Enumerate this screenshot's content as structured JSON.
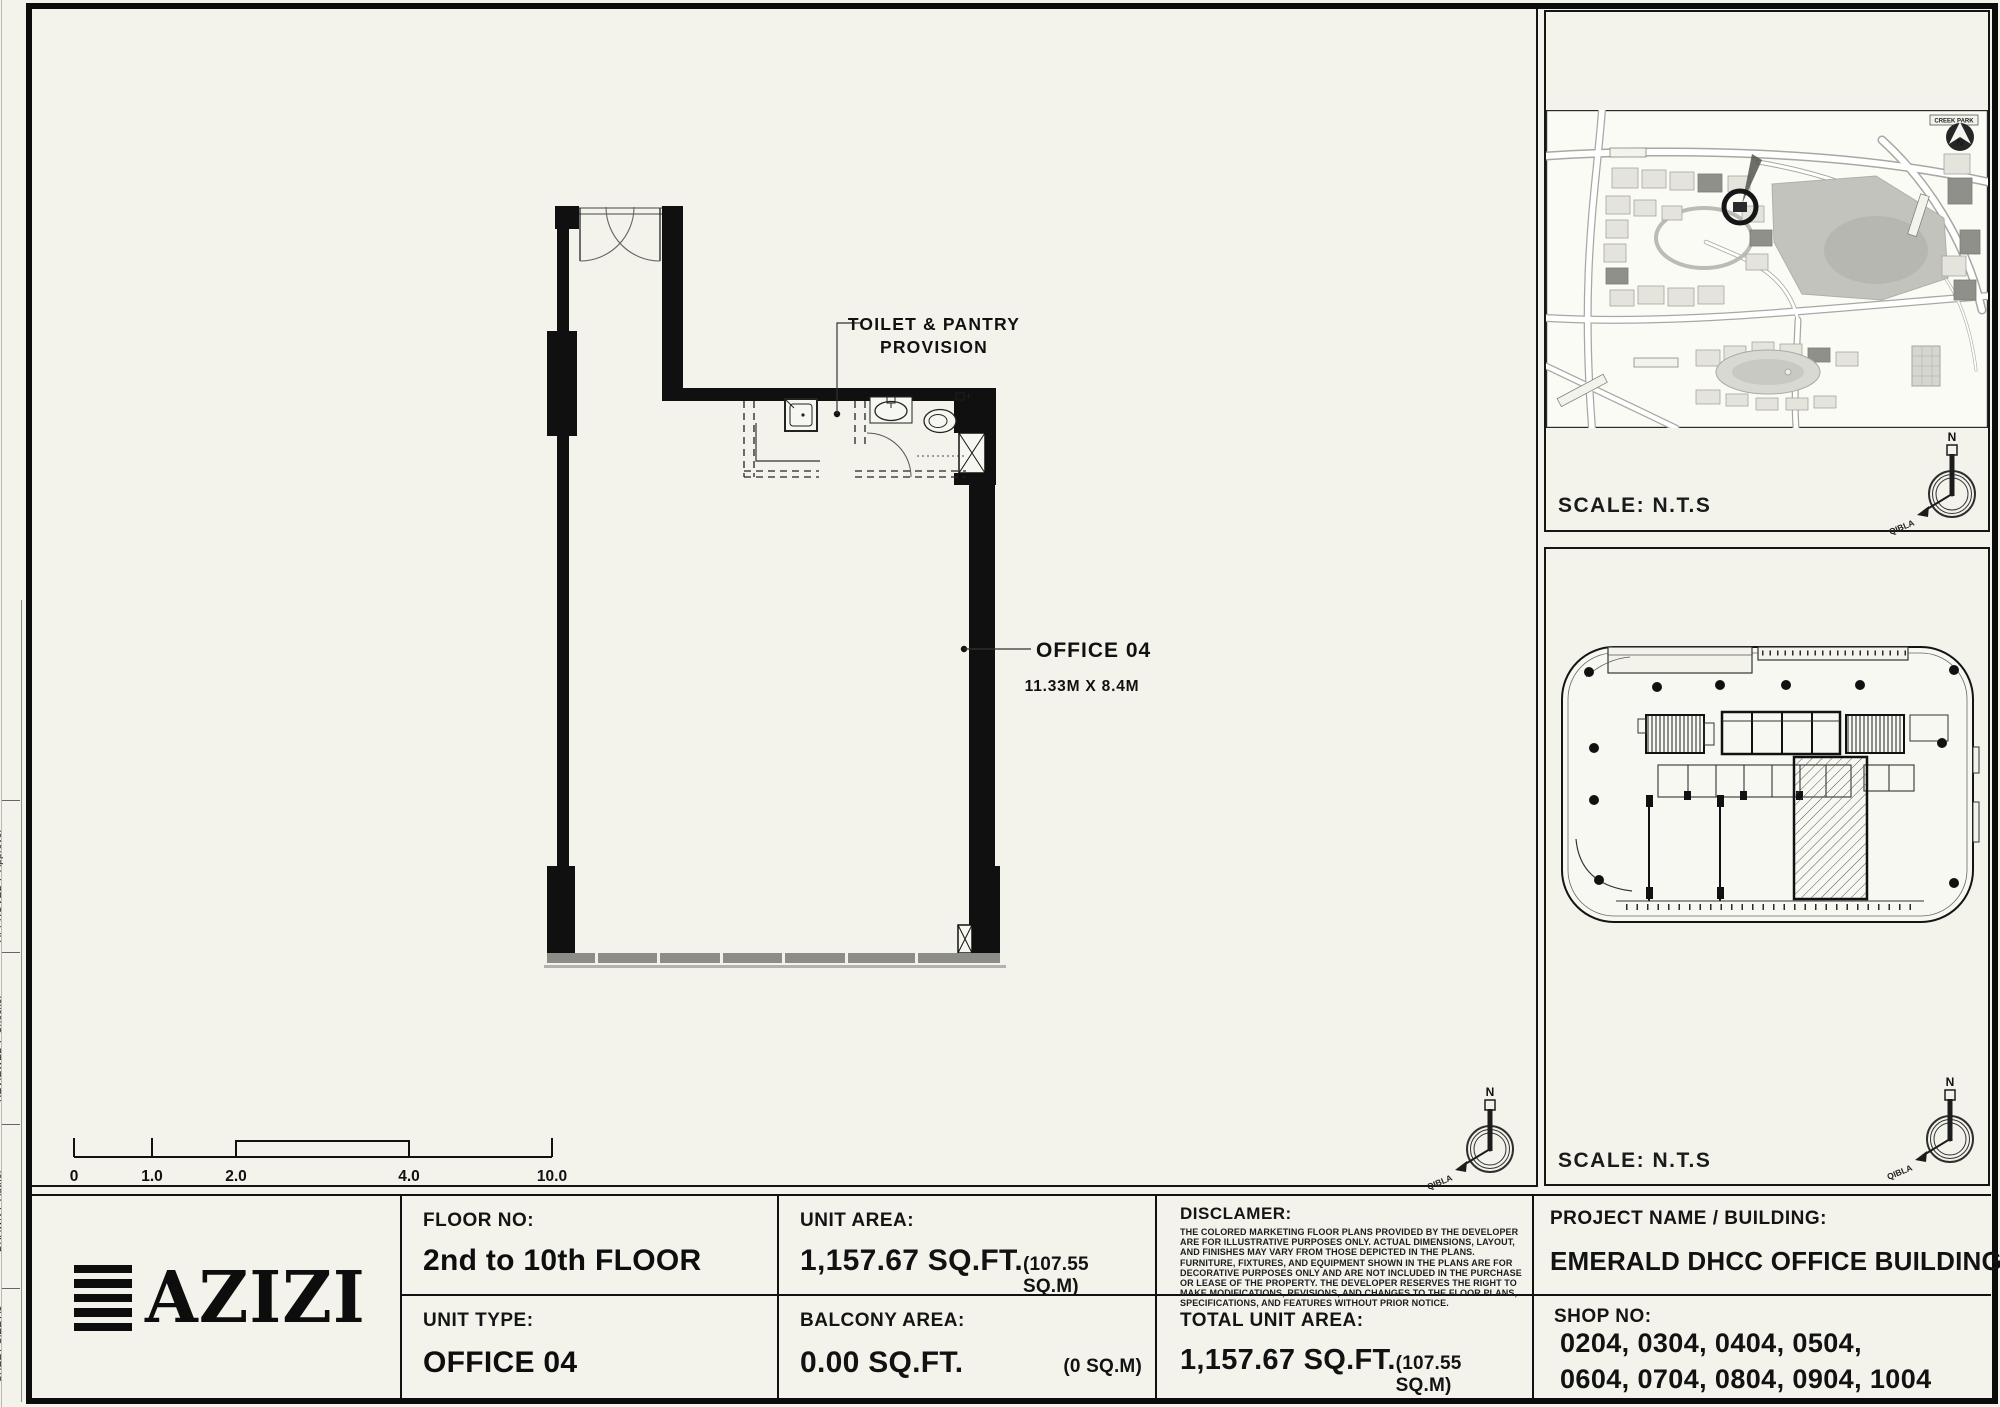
{
  "margin": {
    "sheet_size": "SHEET SIZE A3",
    "drawn_label": "DRAWN :",
    "drawn_value": "Author",
    "reviewed_label": "REVIEWED :",
    "reviewed_value": "Checker",
    "approved_label": "APPROVED :",
    "approved_value": "Approver"
  },
  "plan": {
    "provision_line1": "TOILET & PANTRY",
    "provision_line2": "PROVISION",
    "room_label": "OFFICE 04",
    "room_dims": "11.33M X 8.4M"
  },
  "scalebar": {
    "labels": [
      "0",
      "1.0",
      "2.0",
      "4.0",
      "10.0"
    ]
  },
  "compass": {
    "north": "N",
    "qibla": "QIBLA"
  },
  "map_panel": {
    "scale_label": "SCALE: N.T.S",
    "creek_label": "CREEK PARK",
    "north_badge": "N"
  },
  "keyplan_panel": {
    "scale_label": "SCALE: N.T.S"
  },
  "titleblock": {
    "brand": "AZIZI",
    "floor_label": "FLOOR NO:",
    "floor_value": "2nd to 10th FLOOR",
    "unit_type_label": "UNIT TYPE:",
    "unit_type_value": "OFFICE 04",
    "unit_area_label": "UNIT AREA:",
    "unit_area_value": "1,157.67 SQ.FT.",
    "unit_area_metric": "(107.55 SQ.M)",
    "balcony_label": "BALCONY AREA:",
    "balcony_value": "0.00 SQ.FT.",
    "balcony_metric": "(0 SQ.M)",
    "disclaimer_label": "DISCLAMER:",
    "disclaimer_text": "THE COLORED MARKETING FLOOR PLANS PROVIDED BY THE DEVELOPER ARE FOR ILLUSTRATIVE PURPOSES ONLY. ACTUAL DIMENSIONS, LAYOUT, AND FINISHES MAY VARY FROM THOSE DEPICTED IN THE PLANS. FURNITURE, FIXTURES, AND EQUIPMENT SHOWN IN THE PLANS ARE FOR DECORATIVE PURPOSES ONLY AND ARE NOT INCLUDED IN THE PURCHASE OR LEASE OF THE PROPERTY. THE DEVELOPER RESERVES THE RIGHT TO MAKE MODIFICATIONS, REVISIONS, AND CHANGES TO THE FLOOR PLANS, SPECIFICATIONS, AND FEATURES WITHOUT PRIOR NOTICE.",
    "total_label": "TOTAL UNIT AREA:",
    "total_value": "1,157.67 SQ.FT.",
    "total_metric": "(107.55 SQ.M)",
    "project_label": "PROJECT NAME / BUILDING:",
    "project_value": "EMERALD DHCC OFFICE BUILDING",
    "shop_label": "SHOP NO:",
    "shop_line1": "0204, 0304, 0404, 0504,",
    "shop_line2": "0604, 0704, 0804, 0904, 1004"
  }
}
